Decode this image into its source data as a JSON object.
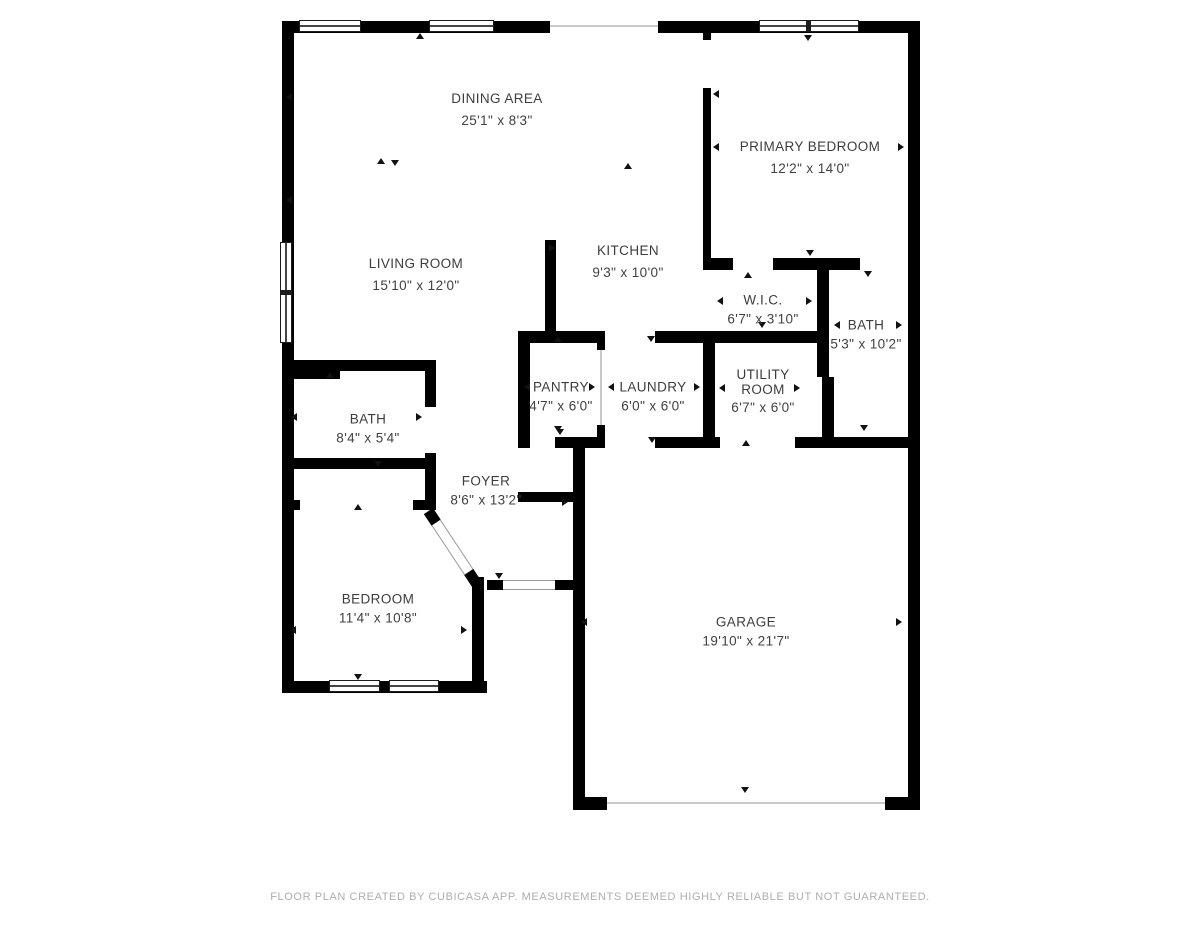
{
  "rooms": [
    {
      "name": "DINING AREA",
      "dims": "25'1\" x 8'3\""
    },
    {
      "name": "PRIMARY BEDROOM",
      "dims": "12'2\" x 14'0\""
    },
    {
      "name": "LIVING ROOM",
      "dims": "15'10\" x 12'0\""
    },
    {
      "name": "KITCHEN",
      "dims": "9'3\" x 10'0\""
    },
    {
      "name": "W.I.C.",
      "dims": "6'7\" x 3'10\""
    },
    {
      "name": "BATH",
      "dims": "5'3\" x 10'2\""
    },
    {
      "name": "PANTRY",
      "dims": "4'7\" x 6'0\""
    },
    {
      "name": "LAUNDRY",
      "dims": "6'0\" x 6'0\""
    },
    {
      "name": "UTILITY ROOM",
      "dims": "6'7\" x 6'0\""
    },
    {
      "name": "BATH",
      "dims": "8'4\" x 5'4\""
    },
    {
      "name": "FOYER",
      "dims": "8'6\" x 13'2\""
    },
    {
      "name": "BEDROOM",
      "dims": "11'4\" x 10'8\""
    },
    {
      "name": "GARAGE",
      "dims": "19'10\" x 21'7\""
    }
  ],
  "footer": {
    "text": "FLOOR PLAN CREATED BY CUBICASA APP. MEASUREMENTS DEEMED HIGHLY RELIABLE BUT NOT GUARANTEED."
  },
  "colors": {
    "wall": "#000000",
    "label_text": "#3d3d3d",
    "footer_text": "#aeaeae",
    "opening_line": "#c9c9c9"
  }
}
